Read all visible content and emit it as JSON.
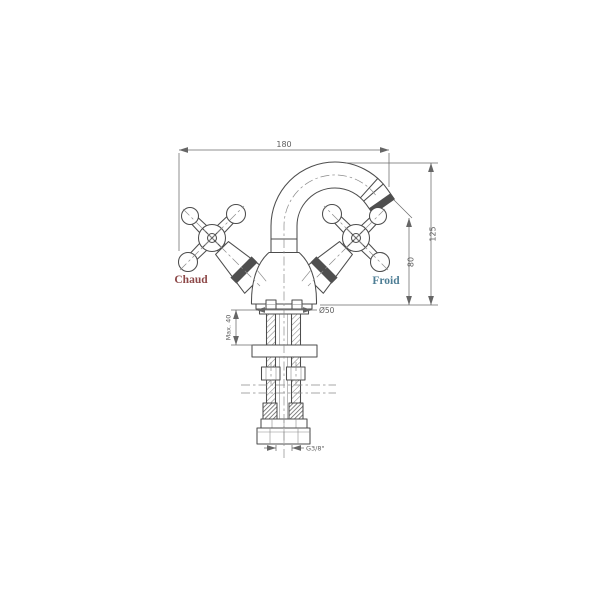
{
  "drawing": {
    "labels": {
      "hot": "Chaud",
      "cold": "Froid"
    },
    "colors": {
      "line": "#4d4d4d",
      "dimension": "#6a6a6a",
      "hot": "#8d4848",
      "cold": "#4e7e95",
      "background": "#ffffff"
    },
    "dimensions": {
      "overall_width": "180",
      "overall_height": "125",
      "spout_outlet_height": "80",
      "max_deck_thickness": "Max. 40",
      "base_diameter": "Ø50",
      "supply_thread": "G3/8\""
    }
  }
}
